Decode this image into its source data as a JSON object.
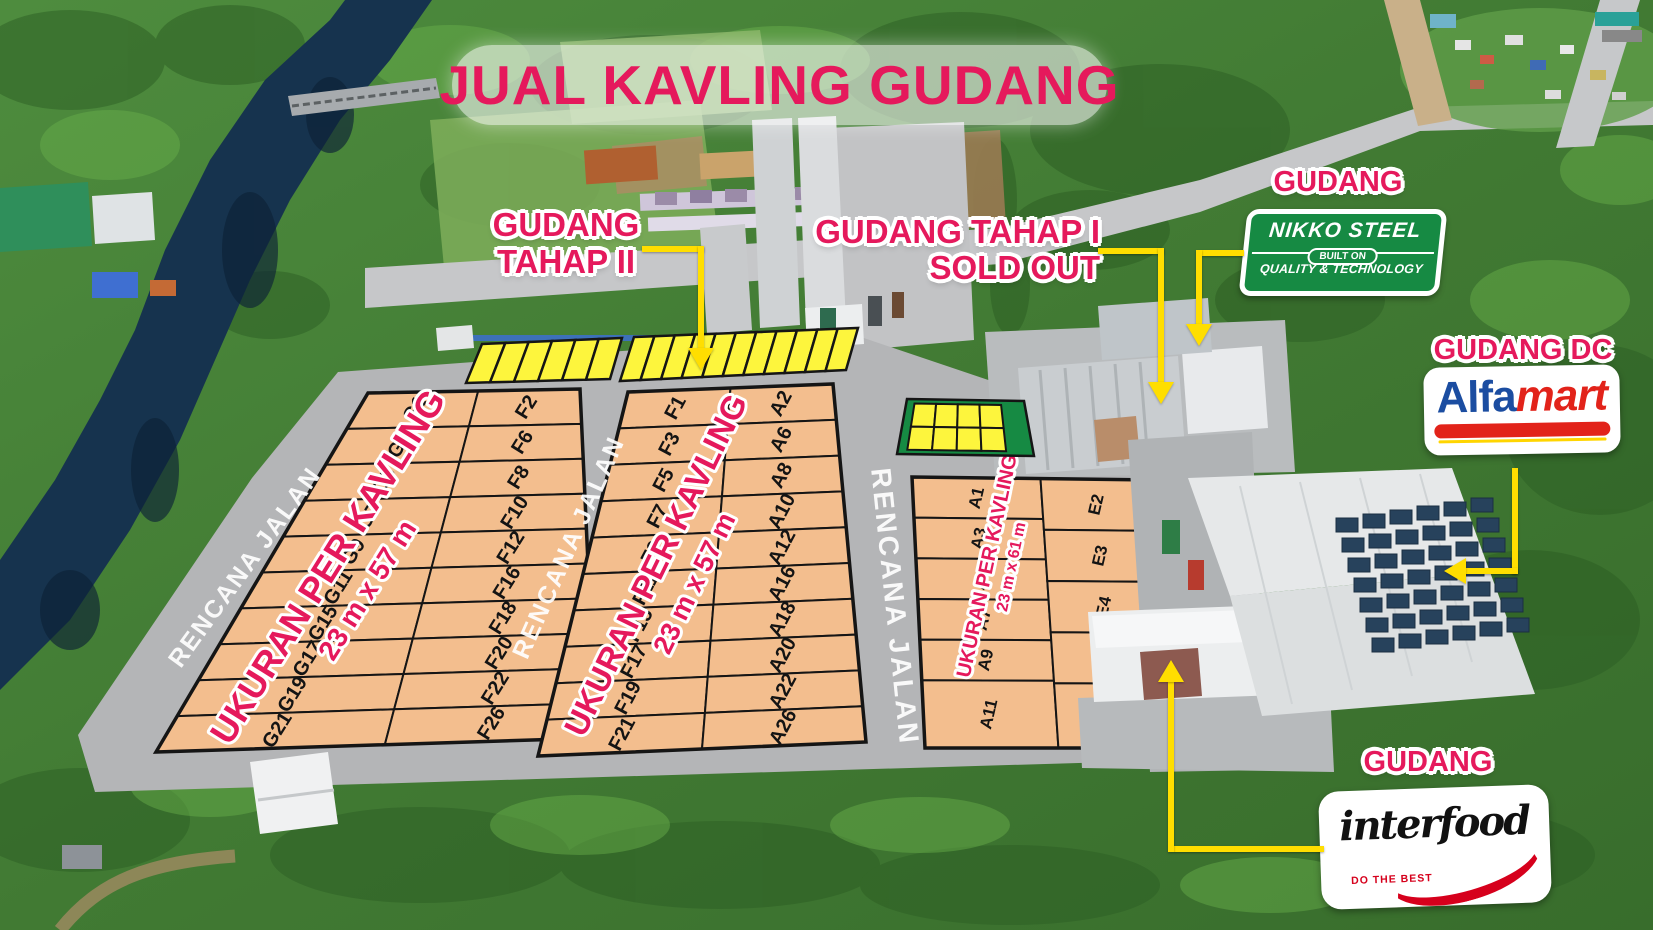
{
  "title": "JUAL KAVLING GUDANG",
  "site_plan": {
    "road_label": "RENCANA JALAN",
    "blocks": [
      {
        "id": "block-west",
        "size_label_line1": "UKURAN PER KAVLING",
        "size_label_line2": "23 m x 57 m",
        "columns": [
          {
            "plots": [
              "G1",
              "G3",
              "G5",
              "G7",
              "G9",
              "G11",
              "G15",
              "G17",
              "G19",
              "G21"
            ]
          },
          {
            "plots": [
              "F2",
              "F6",
              "F8",
              "F10",
              "F12",
              "F16",
              "F18",
              "F20",
              "F22",
              "F26"
            ]
          }
        ]
      },
      {
        "id": "block-center",
        "size_label_line1": "UKURAN PER KAVLING",
        "size_label_line2": "23 m x 57 m",
        "columns": [
          {
            "plots": [
              "F1",
              "F3",
              "F5",
              "F7",
              "F9",
              "F11",
              "F15",
              "F17",
              "F19",
              "F21"
            ]
          },
          {
            "plots": [
              "A2",
              "A6",
              "A8",
              "A10",
              "A12",
              "A16",
              "A18",
              "A20",
              "A22",
              "A26"
            ]
          }
        ]
      },
      {
        "id": "block-east",
        "size_label_line1": "UKURAN PER KAVLING",
        "size_label_line2": "23 m x 61 m",
        "columns": [
          {
            "plots": [
              "A1",
              "A3",
              "A5",
              "A7",
              "A9",
              "A11"
            ]
          },
          {
            "plots": [
              "E2",
              "E3",
              "E4",
              "E5",
              ""
            ]
          }
        ]
      }
    ]
  },
  "callouts": {
    "tahap2": {
      "line1": "GUDANG",
      "line2": "TAHAP II"
    },
    "tahap1": {
      "line1": "GUDANG TAHAP I",
      "line2": "SOLD OUT"
    },
    "nikko": {
      "label": "GUDANG",
      "name": "NIKKO STEEL",
      "built_on": "BUILT ON",
      "tagline": "QUALITY & TECHNOLOGY"
    },
    "alfamart": {
      "label": "GUDANG DC",
      "brand_blue": "Alfa",
      "brand_red": "mart"
    },
    "interfood": {
      "label": "GUDANG",
      "brand": "interfood",
      "tagline": "DO THE BEST"
    }
  },
  "colors": {
    "accent_pink": "#E5195C",
    "plot_fill": "#F3BE8E",
    "highlight_yellow": "#FDF53D",
    "arrow_yellow": "#FFDE00",
    "sign_green": "#168A43",
    "alfamart_blue": "#1B4DA1",
    "alfamart_red": "#E2231A",
    "interfood_red": "#D6001C"
  }
}
